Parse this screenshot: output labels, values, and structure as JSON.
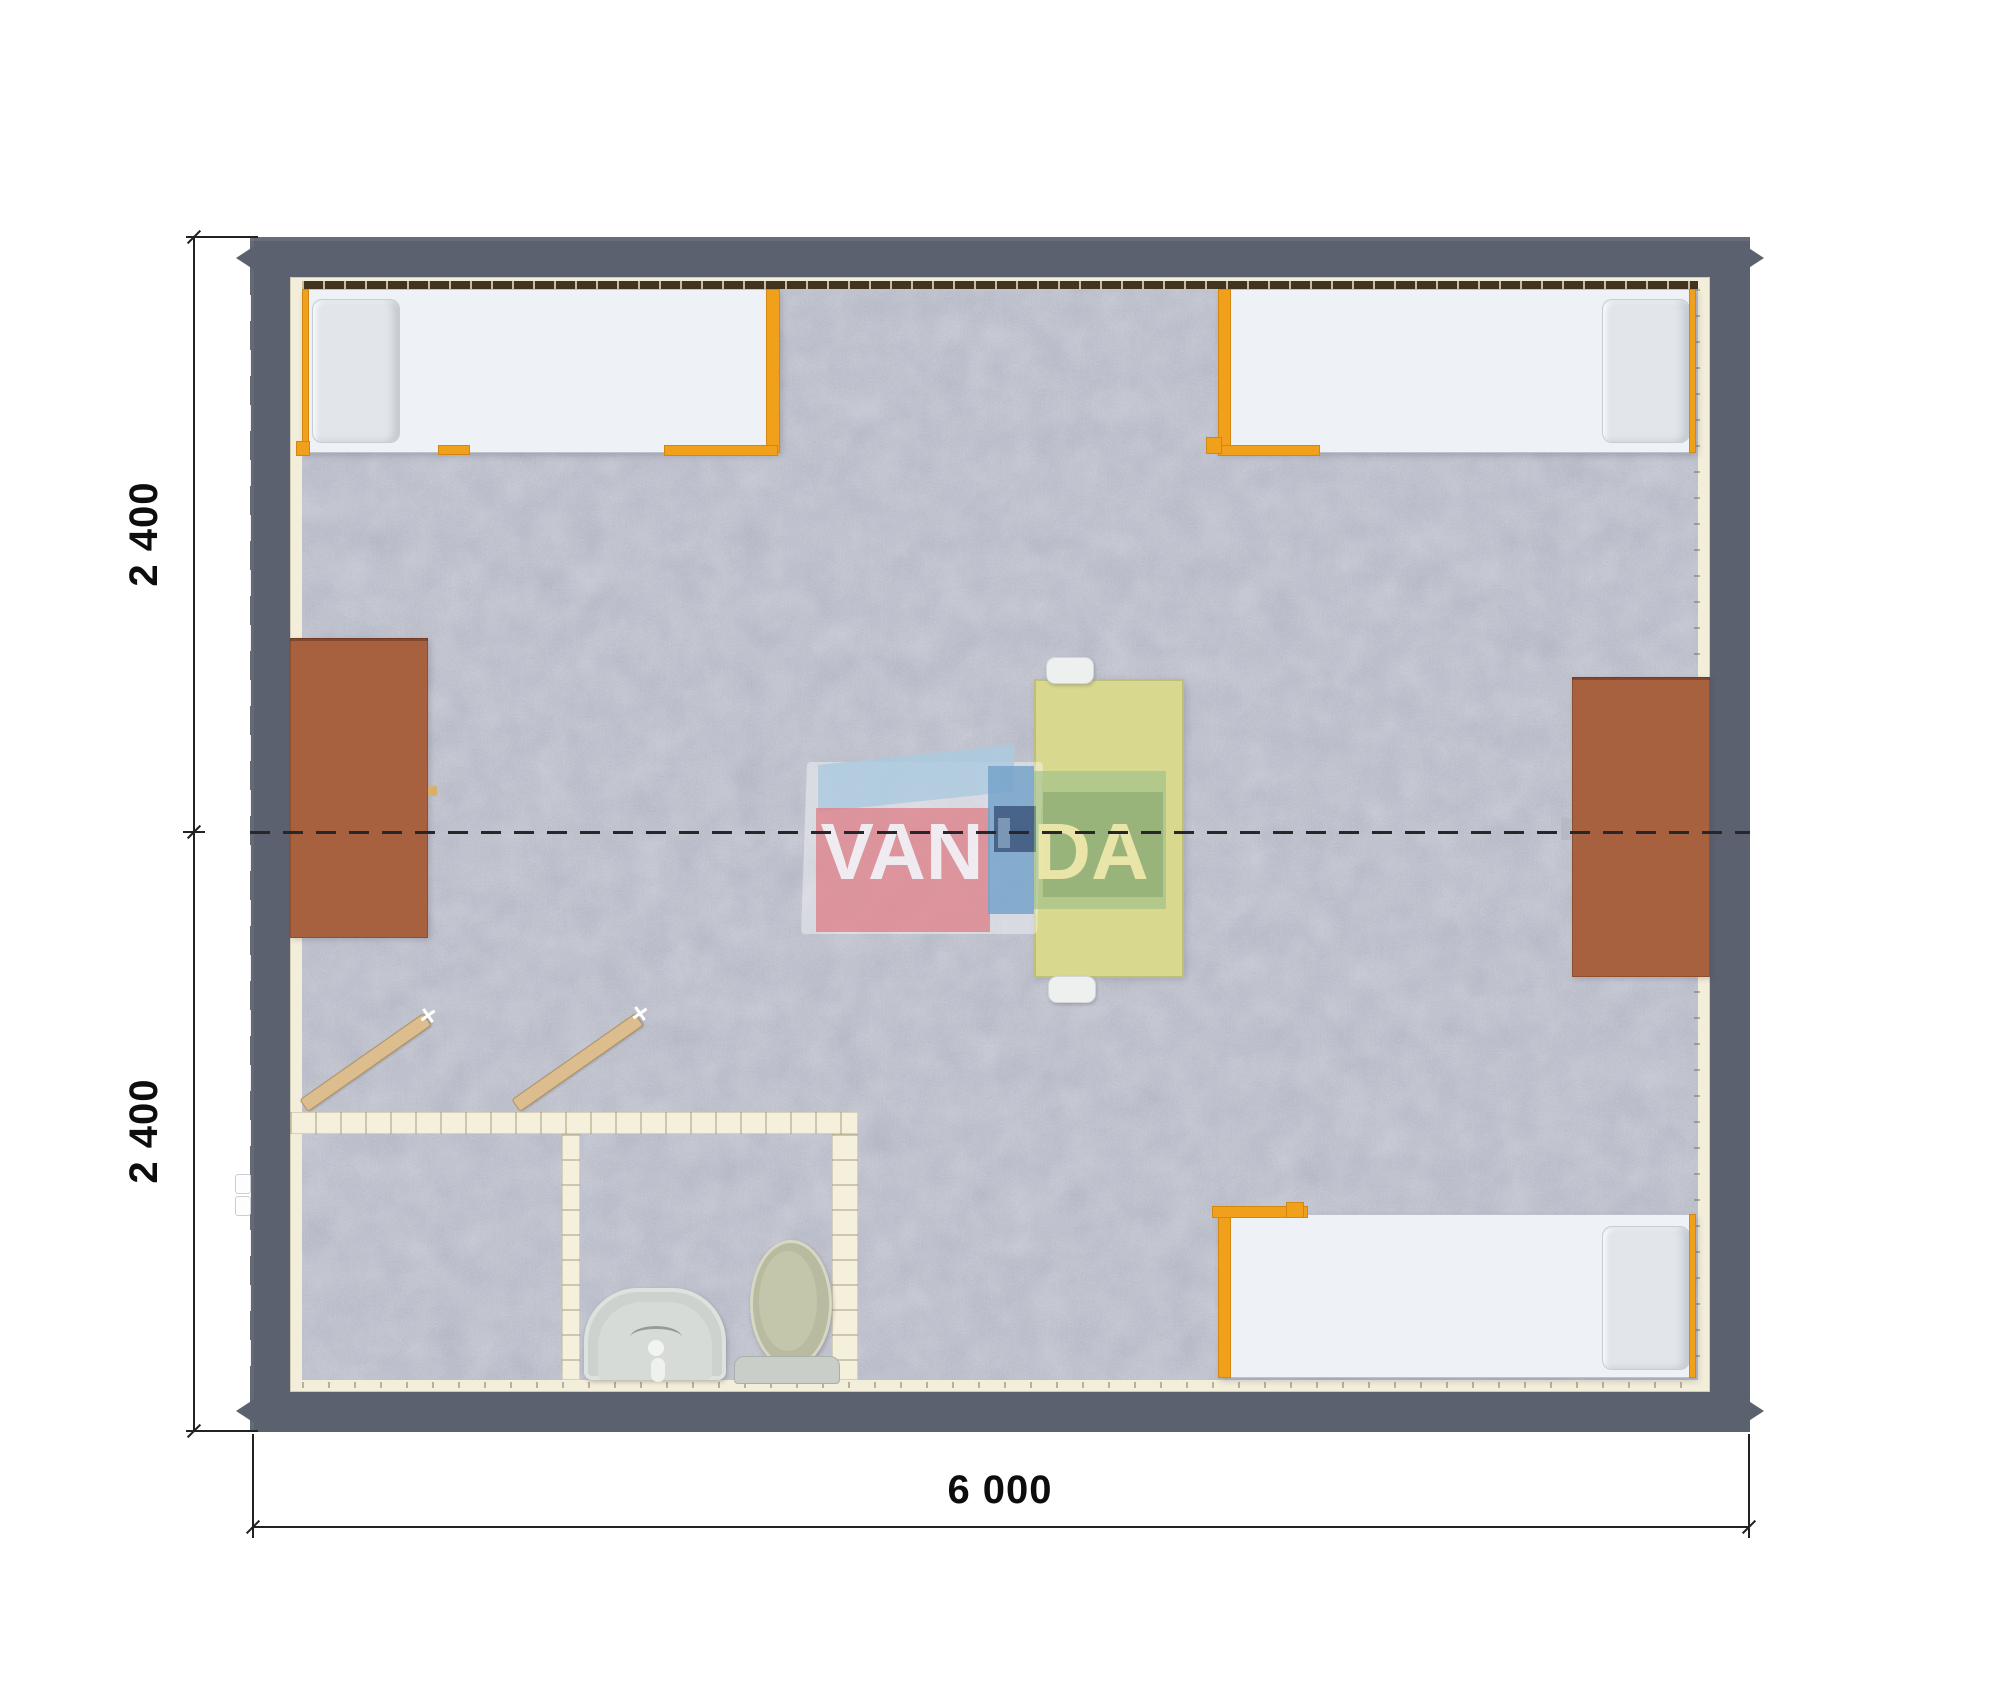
{
  "title": "Modular building floor plan render",
  "dimensions": {
    "width_label": "6 000",
    "height_top_label": "2 400",
    "height_bottom_label": "2 400",
    "building_width_mm": 6000,
    "module_depth_mm": 2400,
    "module_count": 2
  },
  "watermark": {
    "van": "VAN",
    "da": "DA"
  },
  "colors": {
    "wall": "#5b616e",
    "floor_carpet": "#bec1cb",
    "wall_liner_cream": "#f2eeda",
    "bed_frame_orange": "#f0a01b",
    "bed_mattress": "#eef1f5",
    "desk_brown": "#a8613e",
    "table_yellow_green": "#d8d98e",
    "bathroom_wall_cream": "#f5f0dc",
    "door_wood_tan": "#dcbd8e",
    "logo_red": "#e2777f",
    "logo_blue": "#6a9ec9",
    "logo_green": "#88b488",
    "dimension_line": "#222225"
  },
  "plan_inventory": {
    "rooms": [
      "main room",
      "washroom-left",
      "washroom-right"
    ],
    "fixtures": [
      "single-bed-top-left",
      "single-bed-top-right",
      "single-bed-bottom-right",
      "desk-left-wall",
      "desk-right-wall",
      "center-table",
      "stool-north",
      "stool-south",
      "toilet",
      "washbasin",
      "open-door-left",
      "open-door-right",
      "module-joint-centerline",
      "roof-spout-corners"
    ]
  }
}
